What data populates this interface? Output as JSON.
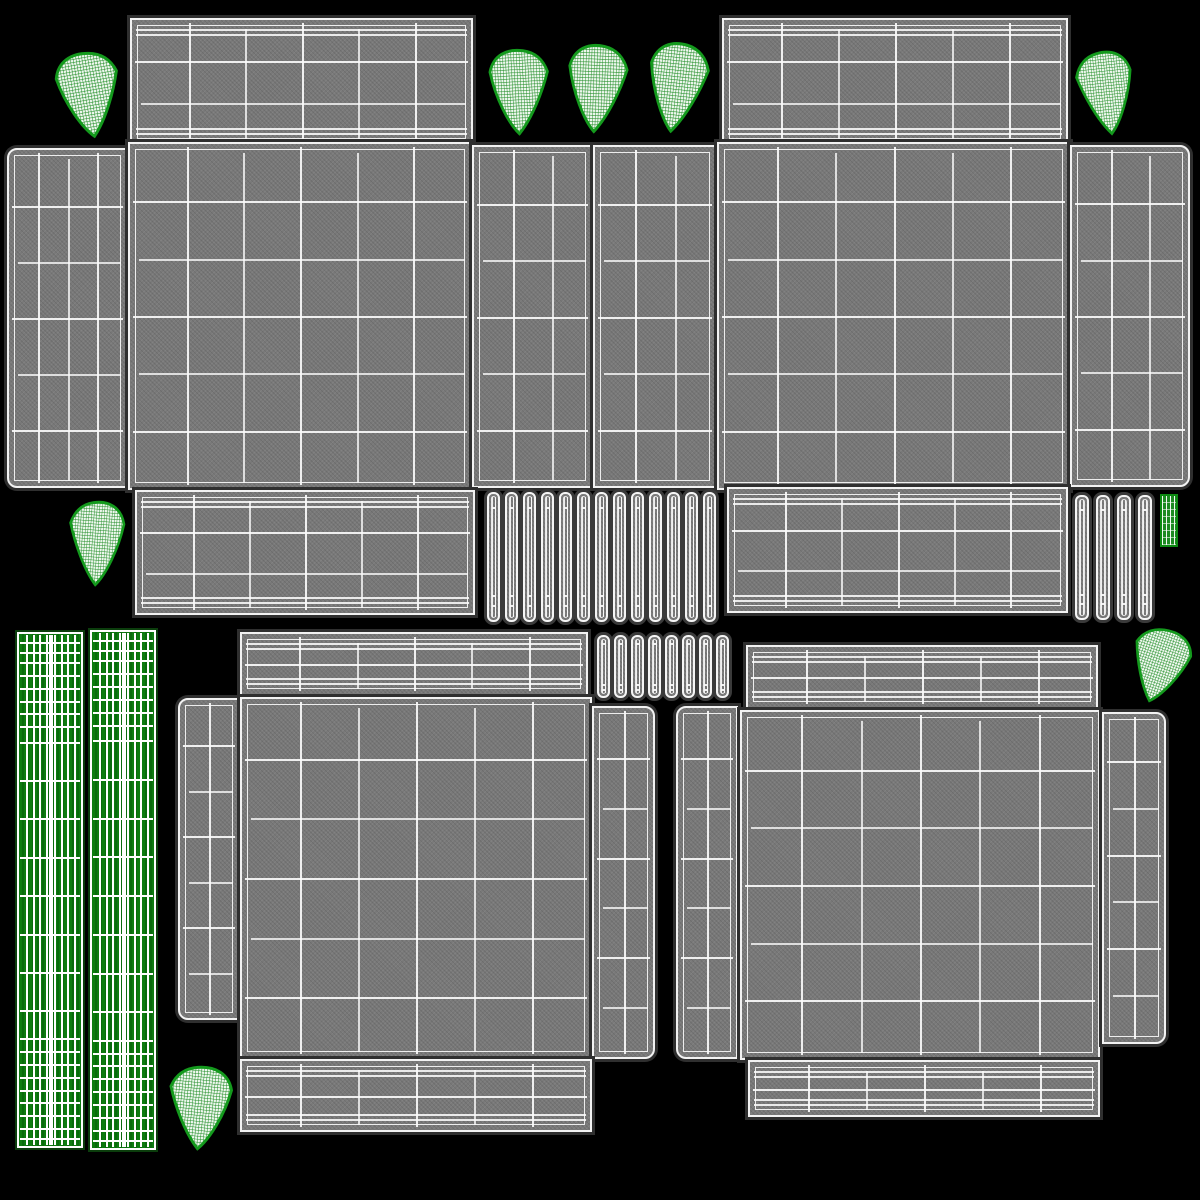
{
  "meta": {
    "description": "UV wireframe texture layout of a 3D packaging model",
    "canvas": {
      "width": 1200,
      "height": 1200,
      "background": "#000000"
    }
  },
  "palette": {
    "panel_fill": "#797979",
    "panel_halo": "#2f2f2f",
    "wire_white": "#f2f2f2",
    "green_strip_fill": "#0e7c10",
    "green_strip_dark": "#0a6b0d",
    "fan_stroke": "#149a1d",
    "fan_grid": "#1f8c25",
    "fan_base": "#eef7ee",
    "green_rect_fill": "#1d8a22"
  },
  "layout": {
    "gray_panels": [
      {
        "id": "a-top-flap",
        "x": 130,
        "y": 18,
        "w": 343,
        "h": 128,
        "cols": 6,
        "rows": 3,
        "dense": true
      },
      {
        "id": "b-top-flap",
        "x": 722,
        "y": 18,
        "w": 346,
        "h": 128,
        "cols": 6,
        "rows": 3,
        "dense": true
      },
      {
        "id": "band-left-flap",
        "x": 7,
        "y": 148,
        "w": 121,
        "h": 340,
        "cols": 4,
        "rows": 6,
        "round": "left"
      },
      {
        "id": "a-central",
        "x": 128,
        "y": 142,
        "w": 344,
        "h": 348,
        "cols": 6,
        "rows": 6
      },
      {
        "id": "band-mid-1",
        "x": 472,
        "y": 145,
        "w": 121,
        "h": 343,
        "cols": 3,
        "rows": 6
      },
      {
        "id": "band-mid-2",
        "x": 593,
        "y": 145,
        "w": 124,
        "h": 343,
        "cols": 3,
        "rows": 6
      },
      {
        "id": "b-central",
        "x": 717,
        "y": 142,
        "w": 353,
        "h": 348,
        "cols": 6,
        "rows": 6
      },
      {
        "id": "b-right-flap",
        "x": 1070,
        "y": 145,
        "w": 120,
        "h": 342,
        "cols": 3,
        "rows": 6,
        "round": "right"
      },
      {
        "id": "a-bottom-flap",
        "x": 135,
        "y": 490,
        "w": 340,
        "h": 125,
        "cols": 6,
        "rows": 3,
        "dense": true
      },
      {
        "id": "b-bottom-flap",
        "x": 727,
        "y": 487,
        "w": 341,
        "h": 126,
        "cols": 6,
        "rows": 3,
        "dense": true
      },
      {
        "id": "c-top-flap",
        "x": 240,
        "y": 632,
        "w": 348,
        "h": 64,
        "cols": 6,
        "rows": 2,
        "dense": true
      },
      {
        "id": "c-left-flap",
        "x": 178,
        "y": 698,
        "w": 62,
        "h": 322,
        "cols": 2,
        "rows": 7,
        "round": "left"
      },
      {
        "id": "c-central",
        "x": 240,
        "y": 697,
        "w": 352,
        "h": 362,
        "cols": 6,
        "rows": 6
      },
      {
        "id": "c-right-flap",
        "x": 592,
        "y": 706,
        "w": 63,
        "h": 353,
        "cols": 2,
        "rows": 7,
        "round": "right"
      },
      {
        "id": "c-bottom-flap",
        "x": 240,
        "y": 1059,
        "w": 352,
        "h": 73,
        "cols": 6,
        "rows": 2,
        "dense": true
      },
      {
        "id": "d-top-flap",
        "x": 746,
        "y": 645,
        "w": 352,
        "h": 64,
        "cols": 6,
        "rows": 2,
        "dense": true
      },
      {
        "id": "d-left-flap",
        "x": 676,
        "y": 706,
        "w": 62,
        "h": 353,
        "cols": 2,
        "rows": 7,
        "round": "left"
      },
      {
        "id": "d-central",
        "x": 740,
        "y": 710,
        "w": 360,
        "h": 350,
        "cols": 6,
        "rows": 6
      },
      {
        "id": "d-right-flap",
        "x": 1102,
        "y": 712,
        "w": 64,
        "h": 332,
        "cols": 2,
        "rows": 7,
        "round": "right"
      },
      {
        "id": "d-bottom-flap",
        "x": 748,
        "y": 1060,
        "w": 352,
        "h": 57,
        "cols": 6,
        "rows": 2,
        "dense": true
      }
    ],
    "strip_rows": [
      {
        "id": "mid-strip-row-1",
        "x": 487,
        "y": 492,
        "count": 13,
        "w": 13,
        "gap": 5,
        "h": 130
      },
      {
        "id": "mid-strip-row-2",
        "x": 597,
        "y": 635,
        "count": 8,
        "w": 13,
        "gap": 4,
        "h": 63
      },
      {
        "id": "right-strip-col",
        "x": 1075,
        "y": 495,
        "count": 4,
        "w": 14,
        "gap": 7,
        "h": 125
      }
    ],
    "green_strips": [
      {
        "id": "green-strip-1",
        "x": 17,
        "y": 632,
        "w": 66,
        "h": 516
      },
      {
        "id": "green-strip-2",
        "x": 90,
        "y": 630,
        "w": 66,
        "h": 520
      }
    ],
    "green_strip_hline_fracs": [
      1.5,
      3.5,
      5.5,
      8,
      10.5,
      13,
      15.5,
      18,
      21,
      28.5,
      36,
      43.5,
      51,
      58.5,
      66,
      73.5,
      79,
      81.5,
      84,
      86.5,
      89,
      91.5,
      94,
      96.5,
      98.5
    ],
    "green_strip_vline_fracs": [
      11,
      22,
      33,
      44,
      56,
      67,
      78,
      89
    ],
    "green_rect": {
      "id": "green-rect",
      "x": 1160,
      "y": 494,
      "w": 18,
      "h": 53
    },
    "fans": [
      {
        "id": "fan-top-left",
        "x": 50,
        "y": 48,
        "w": 76,
        "h": 94,
        "rot": -10,
        "flip": false
      },
      {
        "id": "fan-top-mid-1",
        "x": 482,
        "y": 45,
        "w": 72,
        "h": 94,
        "rot": -3,
        "flip": false
      },
      {
        "id": "fan-top-mid-2",
        "x": 560,
        "y": 40,
        "w": 72,
        "h": 97,
        "rot": 2,
        "flip": false
      },
      {
        "id": "fan-top-mid-3",
        "x": 640,
        "y": 38,
        "w": 72,
        "h": 99,
        "rot": 6,
        "flip": false
      },
      {
        "id": "fan-top-right",
        "x": 1073,
        "y": 47,
        "w": 68,
        "h": 92,
        "rot": -6,
        "flip": true
      },
      {
        "id": "fan-left-mid",
        "x": 64,
        "y": 497,
        "w": 67,
        "h": 93,
        "rot": 4,
        "flip": true
      },
      {
        "id": "fan-right-mid",
        "x": 1125,
        "y": 625,
        "w": 70,
        "h": 82,
        "rot": 18,
        "flip": true
      },
      {
        "id": "fan-bottom-left",
        "x": 163,
        "y": 1062,
        "w": 76,
        "h": 92,
        "rot": 6,
        "flip": true
      }
    ]
  }
}
